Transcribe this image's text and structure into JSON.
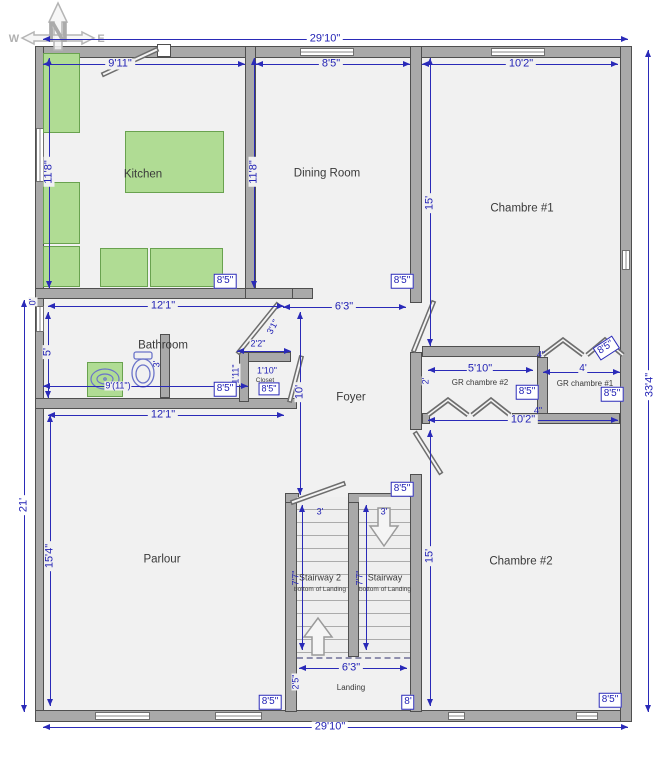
{
  "compass": {
    "n": "N",
    "w": "W",
    "e": "E"
  },
  "rooms": {
    "kitchen": "Kitchen",
    "dining": "Dining Room",
    "chambre1": "Chambre #1",
    "bathroom": "Bathroom",
    "closet": "Closet",
    "foyer": "Foyer",
    "gr2": "GR chambre #2",
    "gr1": "GR chambre #1",
    "parlour": "Parlour",
    "stairway2": "Stairway 2",
    "stairway": "Stairway",
    "chambre2": "Chambre #2",
    "landing": "Landing"
  },
  "stair_note": "bottom of Landing",
  "dims": {
    "total_w_top": "29'10\"",
    "total_w_bottom": "29'10\"",
    "total_h_right": "33'4\"",
    "left_lower": "21'",
    "kitchen_w": "9'11\"",
    "dining_w": "8'5\"",
    "chambre1_w": "10'2\"",
    "kitchen_h": "11'8\"",
    "dining_h": "11'8\"",
    "chambre1_h": "15'",
    "bath_w": "12'1\"",
    "bath_zero": "0'",
    "bath_h": "5'",
    "bath_inner": "9'(11\")",
    "toilet": "3'",
    "parlour_w": "12'1\"",
    "parlour_h": "15'4\"",
    "foyer_w": "6'3\"",
    "foyer_h": "10'",
    "closet_w": "2'2\"",
    "closet_d": "1'10\"",
    "closet_h2": "1'11\"",
    "door_w": "3'1\"",
    "gr2_w": "5'10\"",
    "gr2_d": "2'",
    "gr1_w": "4'",
    "gap_top": "4\"",
    "gap_bottom": "4\"",
    "gr_row_w": "10'2\"",
    "chambre2_h": "15'",
    "stair_w_left": "3'",
    "stair_w_right": "3'",
    "stair_len_left": "7'7\"",
    "stair_len_right": "7'7\"",
    "stair_elev_left": "16'8\"",
    "stair_elev_right": "16'8\"",
    "landing_w": "6'3\"",
    "landing_d": "2'5\""
  },
  "badges": {
    "kitchen": "8'5\"",
    "dining": "8'5\"",
    "bathroom": "8'5\"",
    "closet": "8'5\"",
    "gr2": "8'5\"",
    "gr1": "8'5\"",
    "gr1_door": "8'5\"",
    "stairs": "8'5\"",
    "parlour": "8'5\"",
    "landing": "8'",
    "chambre2": "8'5\""
  }
}
